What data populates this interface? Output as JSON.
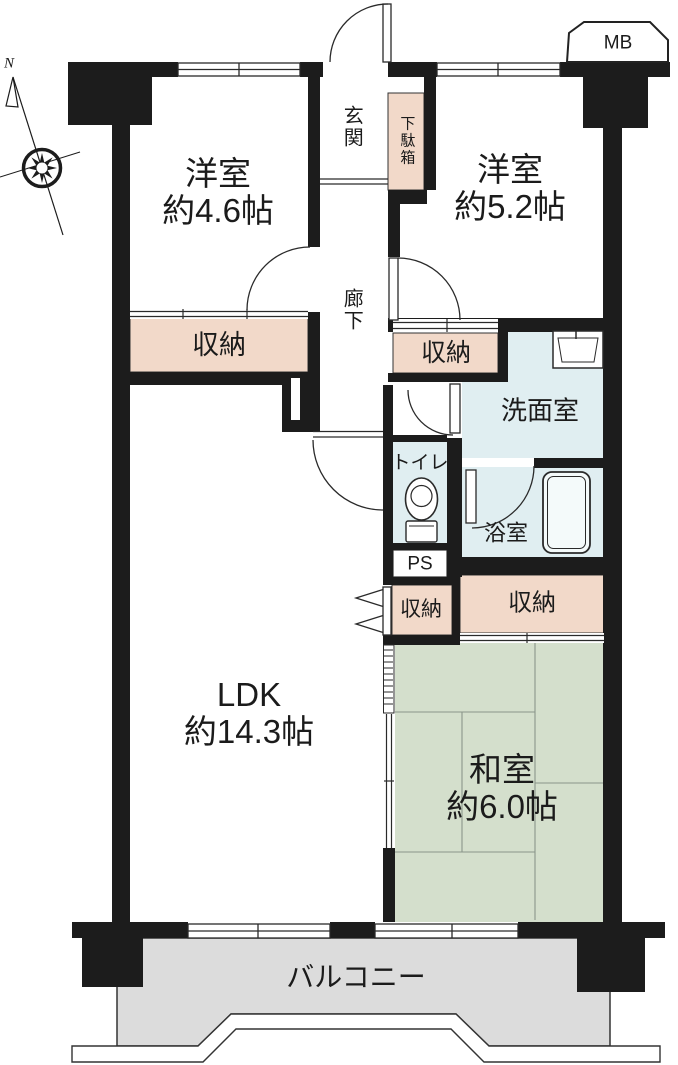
{
  "colors": {
    "wall": "#1c1c1c",
    "storage_fill": "#f2d9c9",
    "wet_area_fill": "#e0eef1",
    "tatami_fill": "#d4dfcc",
    "balcony_fill": "#dcdcdc"
  },
  "compass": {
    "north_label": "N"
  },
  "rooms": {
    "bedroom1": {
      "name": "洋室",
      "area": "約4.6帖"
    },
    "bedroom2": {
      "name": "洋室",
      "area": "約5.2帖"
    },
    "ldk": {
      "name": "LDK",
      "area": "約14.3帖"
    },
    "japanese_room": {
      "name": "和室",
      "area": "約6.0帖"
    },
    "entrance": {
      "name": "玄関"
    },
    "shoe_cabinet": {
      "name": "下駄箱"
    },
    "hallway": {
      "name": "廊下"
    },
    "washroom": {
      "name": "洗面室"
    },
    "toilet": {
      "name": "トイレ"
    },
    "bathroom": {
      "name": "浴室"
    },
    "balcony": {
      "name": "バルコニー"
    },
    "storage_nw": {
      "name": "収納"
    },
    "storage_n": {
      "name": "収納"
    },
    "storage_ldk": {
      "name": "収納"
    },
    "storage_washitsu": {
      "name": "収納"
    },
    "meter_box": {
      "name": "MB"
    },
    "pipe_space": {
      "name": "PS"
    }
  }
}
